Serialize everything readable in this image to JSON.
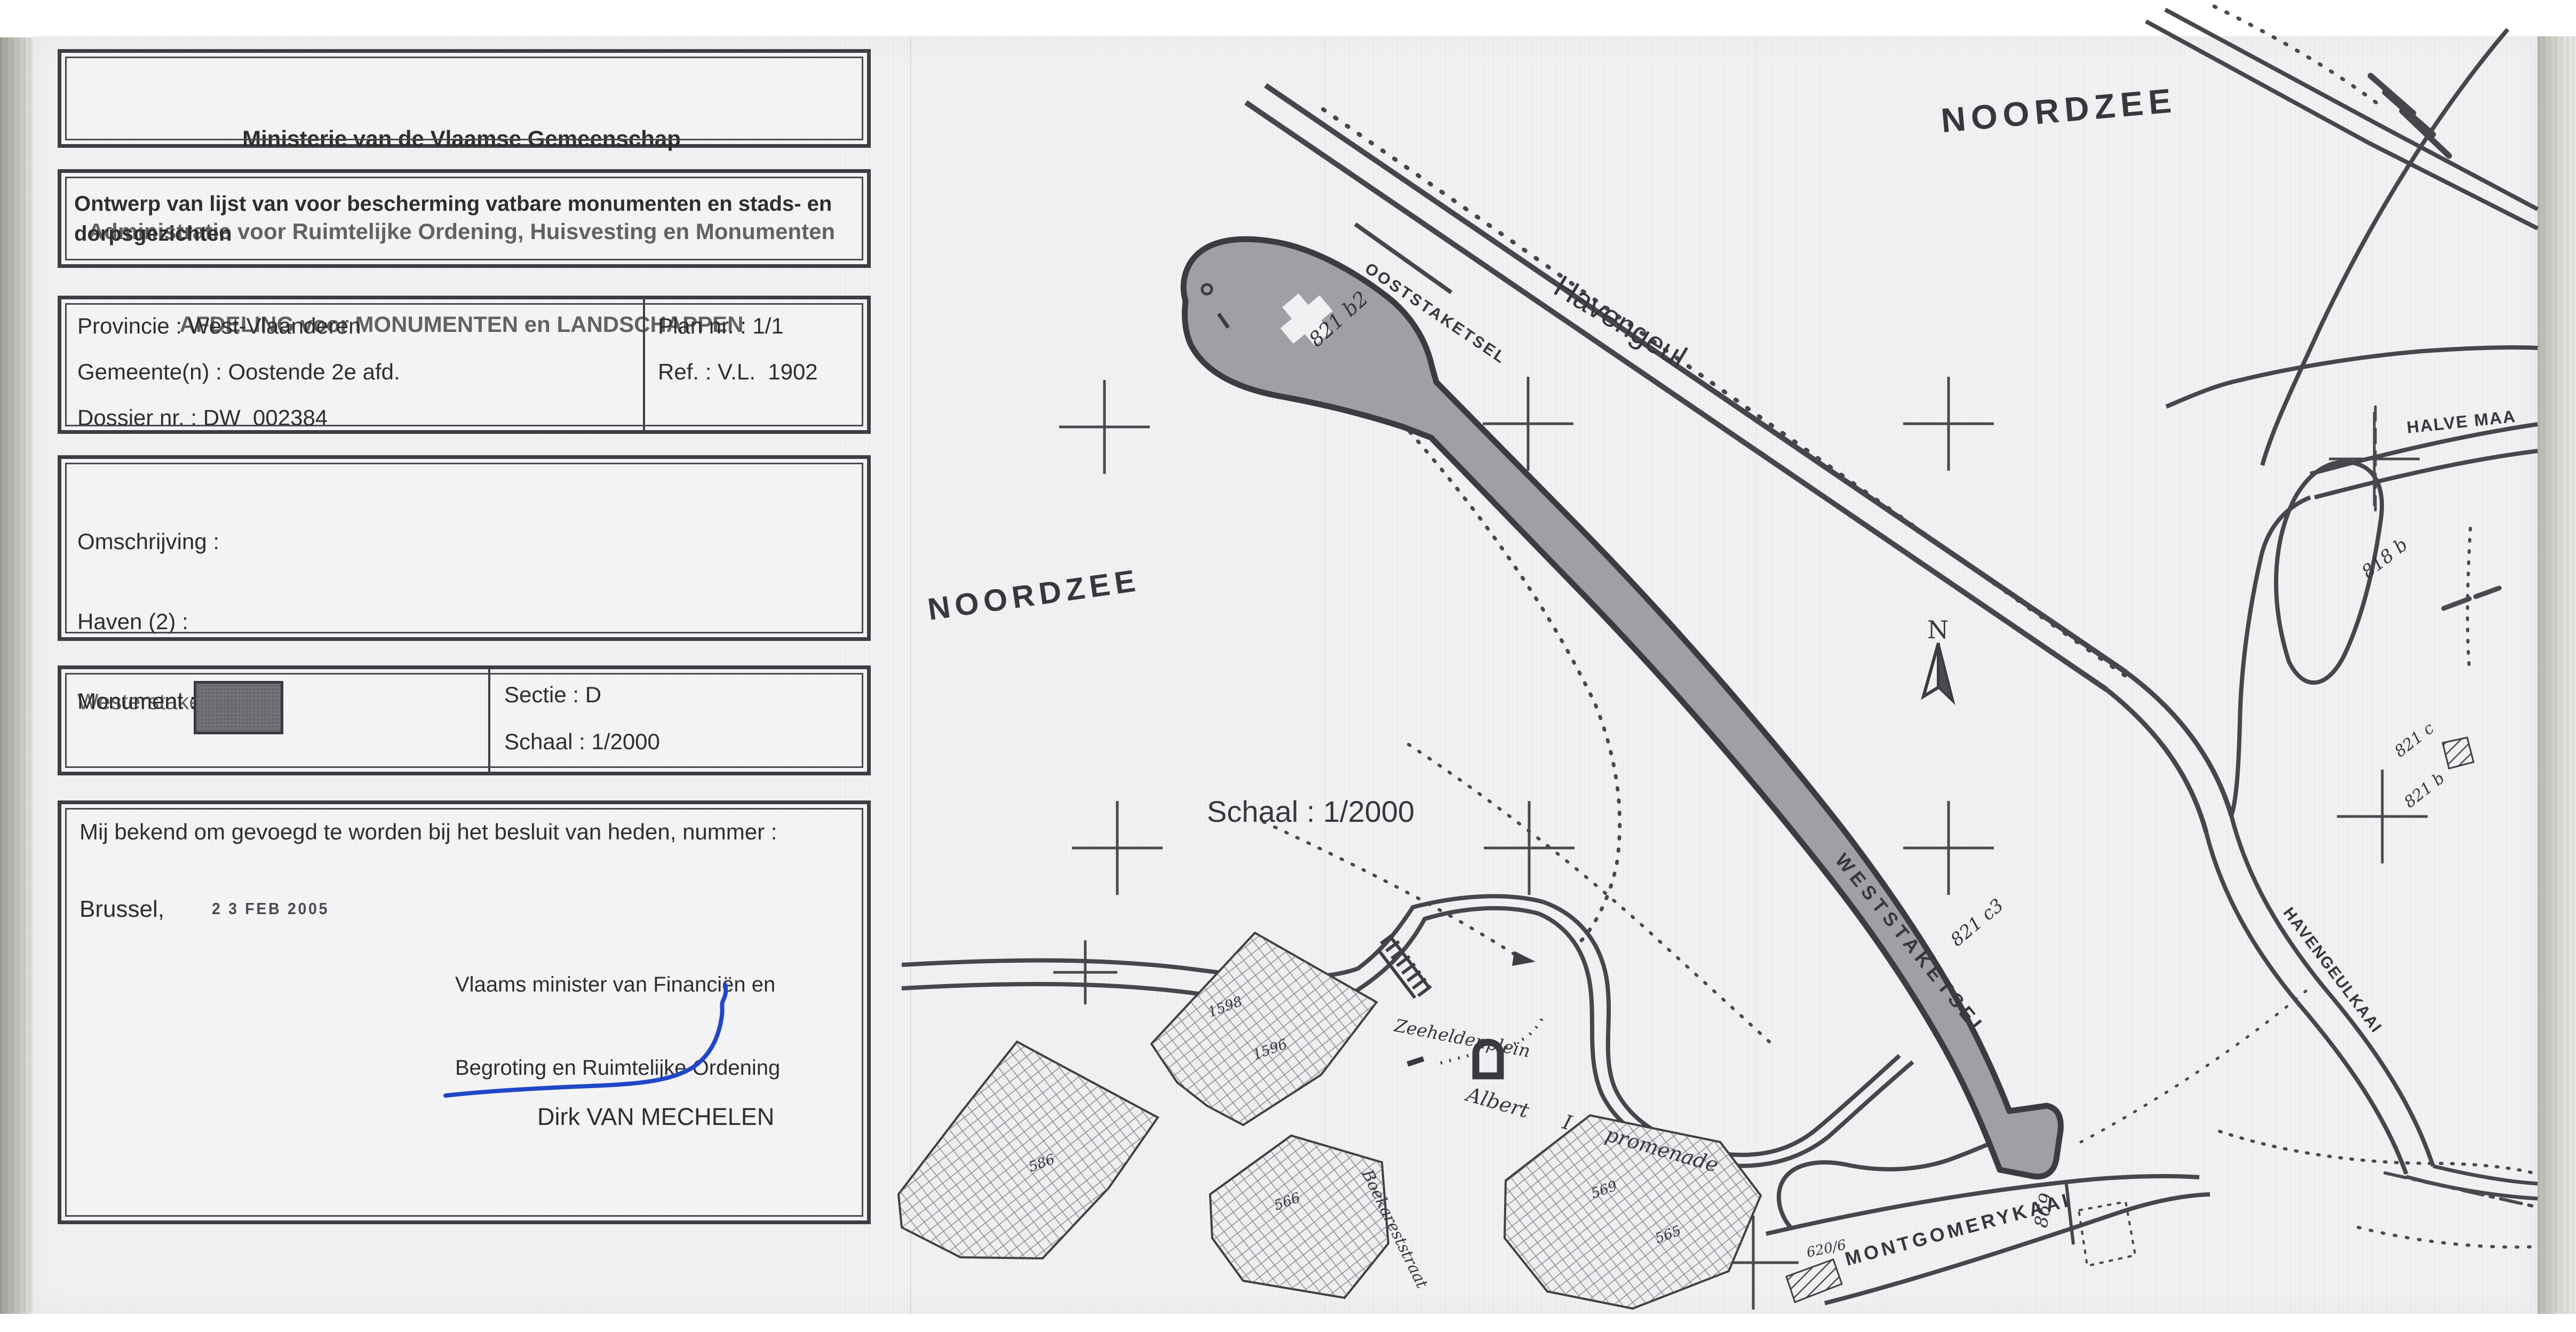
{
  "document": {
    "header_line1": "Ministerie van de Vlaamse Gemeenschap",
    "header_line2": "Administratie voor Ruimtelijke Ordening, Huisvesting en Monumenten",
    "header_line3": "AFDELING voor MONUMENTEN en LANDSCHAPPEN",
    "subject": "Ontwerp van lijst van voor bescherming vatbare monumenten en stads- en dorpsgezichten",
    "province_label": "Provincie : West-Vlaanderen",
    "municipality_label": "Gemeente(n) : Oostende 2e afd.",
    "dossier_label": "Dossier nr. : DW  002384",
    "plan_label": "Plan nr. : 1/1",
    "ref_label": "Ref. : V.L.  1902",
    "description_title": "Omschrijving :",
    "description_line1": "Haven (2) :",
    "description_line2": "Westerstaketsel.",
    "monument_label": "Monument :",
    "sectie_label": "Sectie : D",
    "schaal_label": "Schaal : 1/2000",
    "statement": "Mij bekend om gevoegd te worden bij het besluit van heden, nummer :",
    "city_label": "Brussel,",
    "date_stamp": "2 3 FEB 2005",
    "minister_line1": "Vlaams minister van Financiën en",
    "minister_line2": "Begroting en Ruimtelijke Ordening",
    "signer_name": "Dirk VAN MECHELEN"
  },
  "map": {
    "labels": {
      "noordzee_right": "NOORDZEE",
      "noordzee_left": "NOORDZEE",
      "havengeul": "Havengeul",
      "schaal": "Schaal : 1/2000",
      "ooststaketsel": "OOSTSTAKETSEL",
      "weststaketsel": "WESTSTAKETSEL",
      "halve_maan": "HALVE MAA",
      "havengeulkaai": "HAVENGEULKAAI",
      "montgomerykaai": "MONTGOMERYKAAI",
      "zeeheldenplein": "Zeeheldenplein",
      "albert_promenade": "Albert I promenade",
      "boekareststraat": "Boekareststraat",
      "compass_n": "N"
    },
    "parcels": {
      "pier_head": "821 b2",
      "pier_mid": "821 c3",
      "banana": "818 b",
      "right_c": "821 c",
      "right_b": "821 b",
      "montgomery": "869",
      "slip": "620/6",
      "block_1598": "1598",
      "block_1596": "1596",
      "block_569": "569",
      "block_565": "565",
      "block_566": "566",
      "block_586": "586"
    },
    "colors": {
      "ink": "#3c3c40",
      "pier_fill": "#9fa0a4",
      "signature_blue": "#2047c8",
      "paper": "#f1f1f4"
    }
  }
}
